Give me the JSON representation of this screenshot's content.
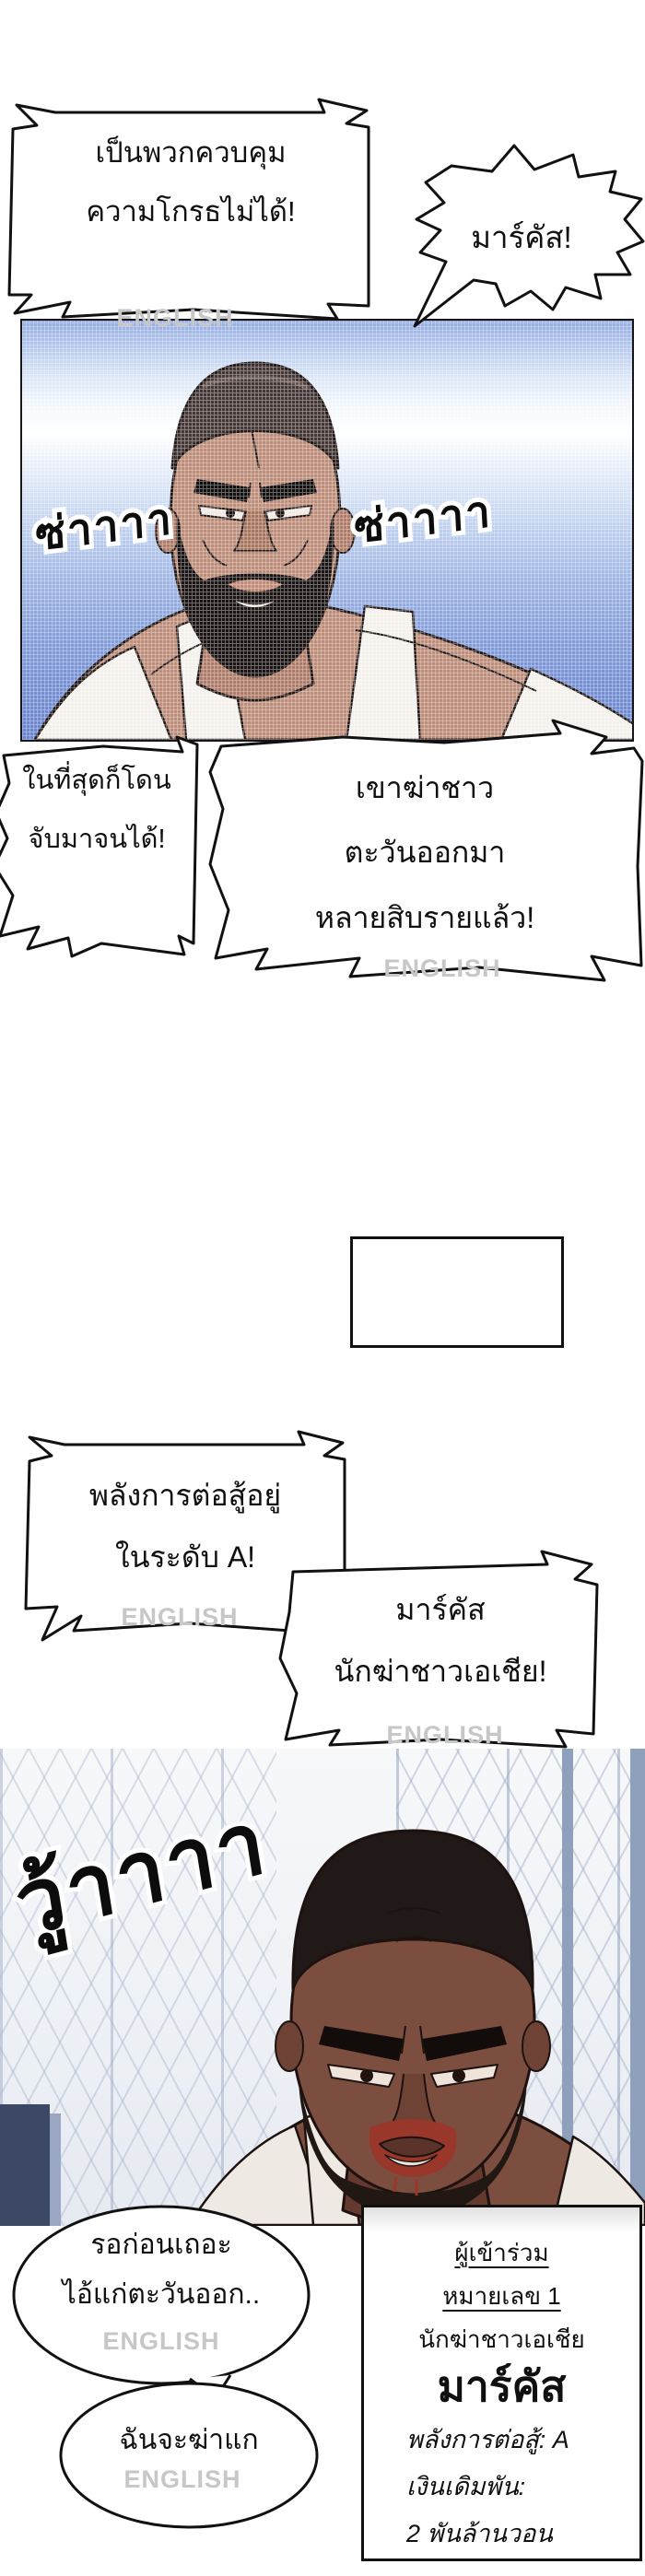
{
  "watermark": "ENGLISH",
  "colors": {
    "panel1_sky_top": "#93abdf",
    "panel1_sky_bottom": "#6a84cd",
    "panel2_bg": "#f4f5f8",
    "sfx_ink": "#0c0c0c",
    "blood": "#98372a",
    "watermark_gray": "#c7c7c7"
  },
  "bubbles": {
    "anger": {
      "line1": "เป็นพวกควบคุม",
      "line2": "ความโกรธไม่ได้!"
    },
    "marcus_shout": {
      "text": "มาร์คัส!"
    },
    "finally_caught": {
      "line1": "ในที่สุดก็โดน",
      "line2": "จับมาจนได้!"
    },
    "killed_many": {
      "line1": "เขาฆ่าชาว",
      "line2": "ตะวันออกมา",
      "line3": "หลายสิบรายแล้ว!"
    },
    "power_level": {
      "line1": "พลังการต่อสู้อยู่",
      "line2": "ในระดับ A!"
    },
    "marcus_title": {
      "line1": "มาร์คัส",
      "line2": "นักฆ่าชาวเอเชีย!"
    },
    "wait_old_man": {
      "line1": "รอก่อนเถอะ",
      "line2": "ไอ้แก่ตะวันออก.."
    },
    "kill_you": {
      "text": "ฉันจะฆ่าแก"
    }
  },
  "sfx": {
    "panel1_left": "ซ่าาาา",
    "panel1_right": "ซ่าาาา",
    "panel2_roar": "วู้าาาา"
  },
  "info_box": {
    "participant_label": "ผู้เข้าร่วม",
    "participant_number": "หมายเลข 1",
    "subtitle": "นักฆ่าชาวเอเชีย",
    "name": "มาร์คัส",
    "power_stat": "พลังการต่อสู้: A",
    "bet_label": "เงินเดิมพัน:",
    "bet_value": "2 พันล้านวอน"
  }
}
